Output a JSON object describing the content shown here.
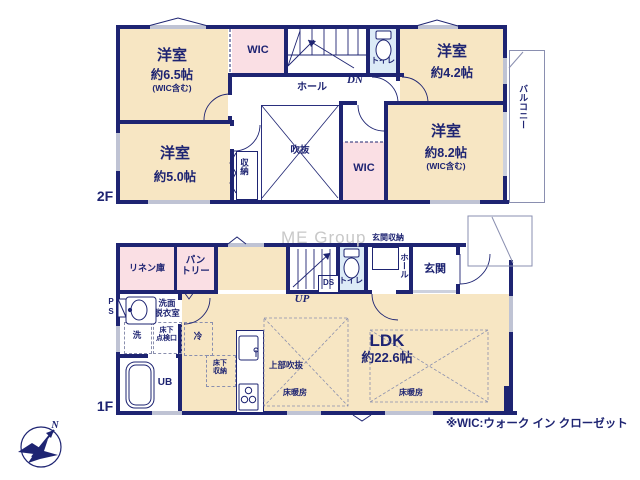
{
  "watermark": "ME Group",
  "footnote": "※WIC:ウォーク イン クローゼット",
  "compass": {
    "north": "N"
  },
  "f2": {
    "floor_label": "2F",
    "room65": {
      "name": "洋室",
      "size": "約6.5帖",
      "note": "(WIC含む)"
    },
    "wic_top": "WIC",
    "toilet": "トイレ",
    "room42": {
      "name": "洋室",
      "size": "約4.2帖"
    },
    "hall": "ホール",
    "dn": "DN",
    "void": "吹抜",
    "room50": {
      "name": "洋室",
      "size": "約5.0帖"
    },
    "closet": "収納",
    "wic_side": "WIC",
    "room82": {
      "name": "洋室",
      "size": "約8.2帖",
      "note": "(WIC含む)"
    },
    "balcony": "バルコニー"
  },
  "f1": {
    "floor_label": "1F",
    "linen": "リネン庫",
    "pantry": {
      "line1": "パン",
      "line2": "トリー"
    },
    "up": "UP",
    "ds": "DS",
    "toilet": "トイレ",
    "entrance_storage": "玄関収納",
    "hall": "ホール",
    "entrance": "玄関",
    "washroom": {
      "line1": "洗面",
      "line2": "脱衣室"
    },
    "ps": "PS",
    "washer": "洗",
    "floor_hatch": {
      "line1": "床下",
      "line2": "点検口"
    },
    "ub": "UB",
    "fridge": "冷",
    "floor_storage": {
      "line1": "床下",
      "line2": "収納"
    },
    "ldk": {
      "name": "LDK",
      "size": "約22.6帖"
    },
    "upper_void": "上部吹抜",
    "floor_heating_left": "床暖房",
    "floor_heating_right": "床暖房"
  }
}
